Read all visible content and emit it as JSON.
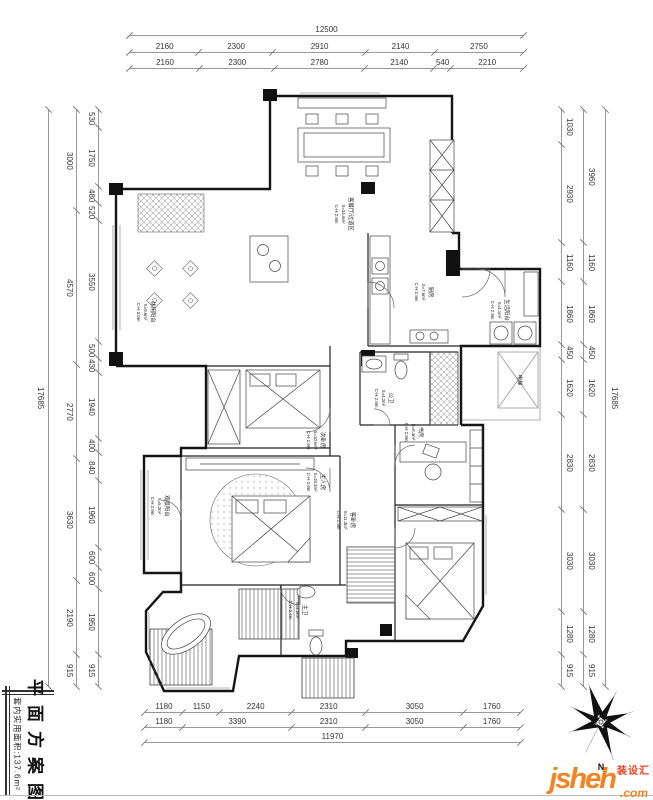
{
  "title_block": {
    "sheet_title": "平面方案图",
    "area_note": "套内实用面积:137.6m²"
  },
  "compass": {
    "label": "N"
  },
  "logo": {
    "brand": "jsheh",
    "suffix": ".com",
    "tag": "装设汇"
  },
  "dims": {
    "top": {
      "total": "12500",
      "row2": [
        "2160",
        "2300",
        "2910",
        "2140",
        "2750"
      ],
      "row3": [
        "2160",
        "2300",
        "2780",
        "2140",
        "540",
        "2210"
      ]
    },
    "bottom": {
      "row1": [
        "1180",
        "1150",
        "2240",
        "2310",
        "3050",
        "1760"
      ],
      "row2": [
        "1180",
        "3390",
        "2310",
        "3050",
        "1760"
      ],
      "total": "11970"
    },
    "left": {
      "total": "17685",
      "outer": [
        "3000",
        "4570",
        "2770",
        "3630",
        "2190",
        "915"
      ],
      "inner": [
        "530",
        "1750",
        "480",
        "520",
        "3550",
        "500",
        "430",
        "1940",
        "400",
        "840",
        "1960",
        "600",
        "600",
        "1950",
        "915"
      ]
    },
    "right": {
      "total": "17685",
      "outer": [
        "3960",
        "1160",
        "1860",
        "450",
        "1620",
        "2830",
        "3030",
        "1280",
        "915"
      ],
      "inner": [
        "1030",
        "2930",
        "1160",
        "1860",
        "450",
        "1620",
        "2830",
        "3030",
        "1280",
        "915"
      ]
    }
  },
  "rooms": [
    {
      "name": "客餐厅/过道区",
      "area": "S=34.6m²",
      "height": "C-H 2.9m"
    },
    {
      "name": "厨房",
      "area": "S=7.6m²",
      "height": "C-H 2.9m"
    },
    {
      "name": "生活阳台",
      "area": "S=4.1m²",
      "height": "C-H 2.9m"
    },
    {
      "name": "休闲阳台",
      "area": "S=9.6m²",
      "height": "C-H 3.0m"
    },
    {
      "name": "公卫",
      "area": "S=4.2m²",
      "height": "C-H 2.9m"
    },
    {
      "name": "次卧房",
      "area": "S=10.6m²",
      "height": "C-H 2.9m"
    },
    {
      "name": "主人房",
      "area": "S=18.2m²",
      "height": "C-H 2.9m"
    },
    {
      "name": "书房",
      "area": "S=8.4m²",
      "height": "C-H 2.9m"
    },
    {
      "name": "客卧房",
      "area": "S=11.3m²",
      "height": "C-H 2.9m"
    },
    {
      "name": "观景阳台",
      "area": "S=5.2m²",
      "height": "C-H 2.9m"
    },
    {
      "name": "主卫",
      "area": "S=4.6m²",
      "height": "C-H 2.4m"
    },
    {
      "name": "电梯",
      "area": "",
      "height": ""
    }
  ]
}
